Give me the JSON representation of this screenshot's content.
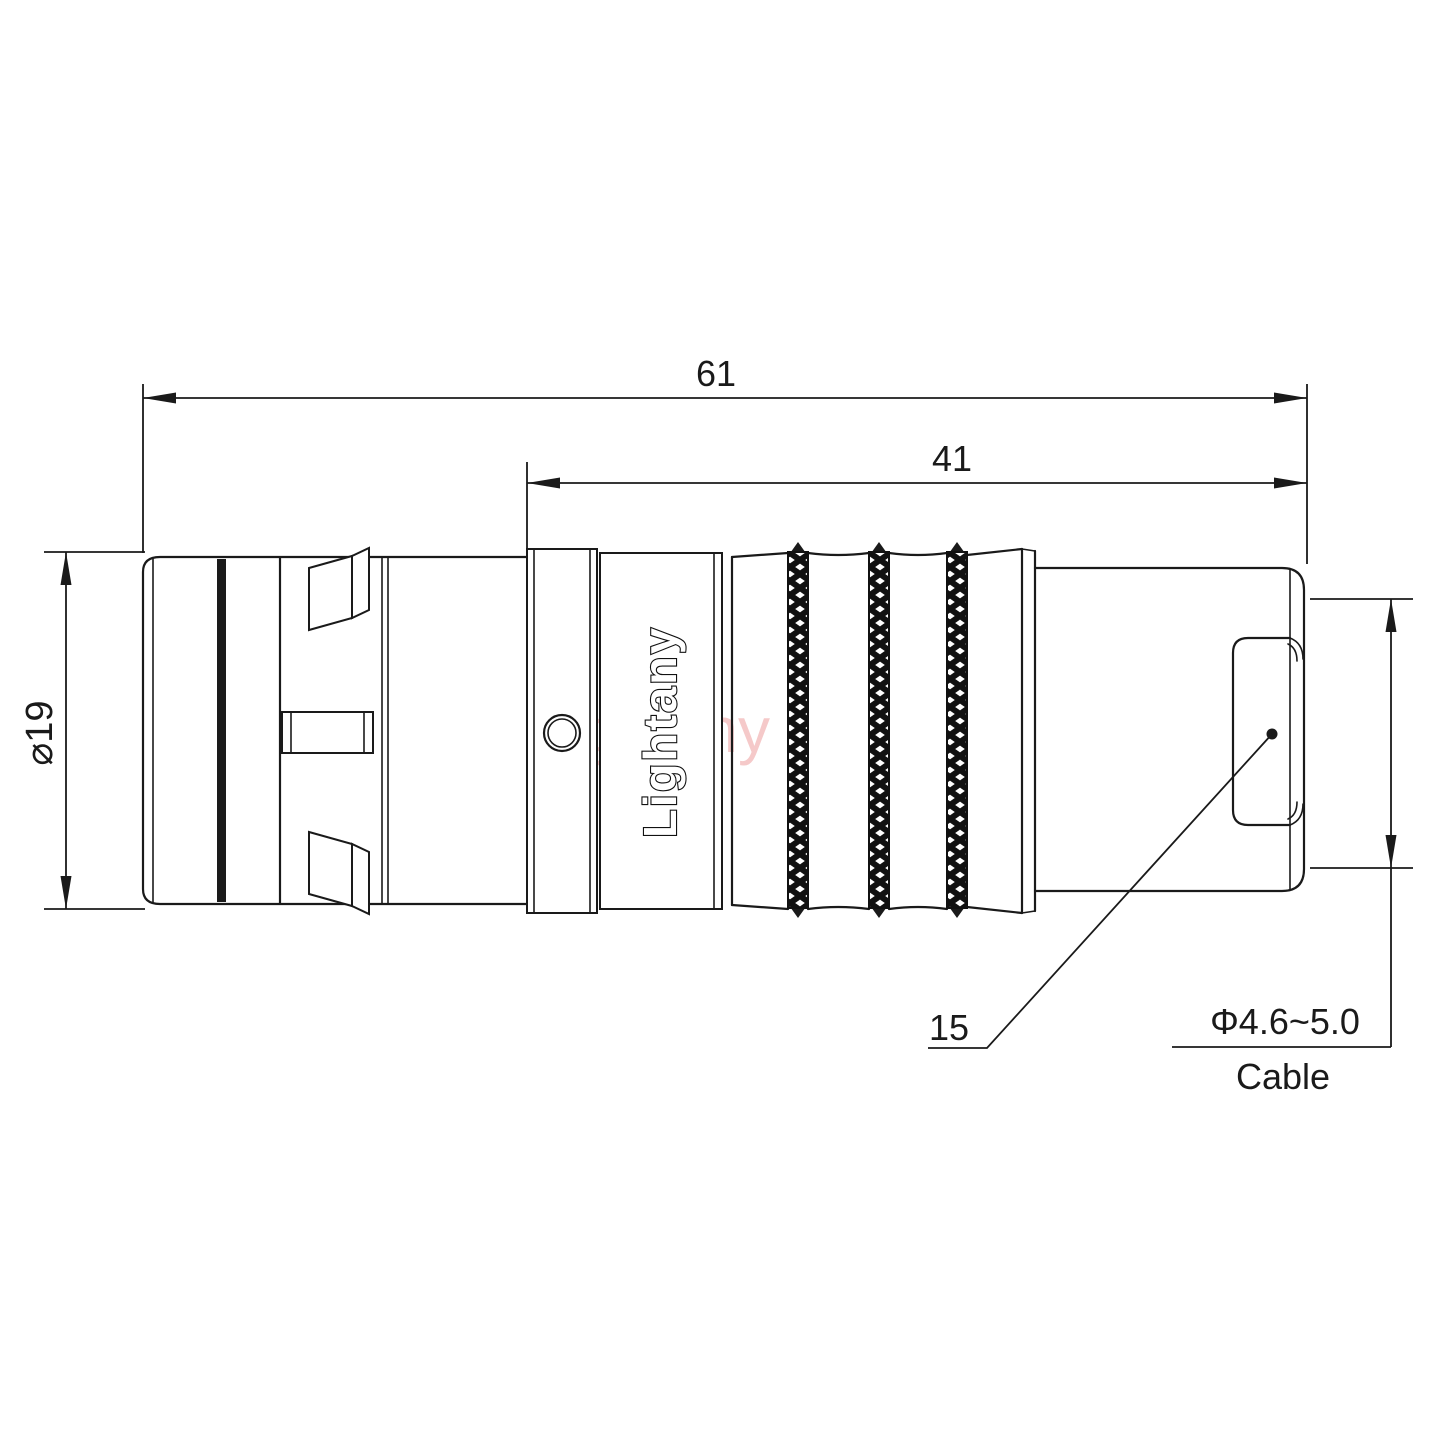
{
  "drawing": {
    "type": "connector-technical-drawing",
    "background": "#ffffff",
    "line_color": "#1a1a1a",
    "watermark_color": "#ec9c9c",
    "dimensions": {
      "overall_length": "61",
      "mid_length": "41",
      "diameter": "⌀19",
      "rear_ref": "15",
      "cable_diameter": "Φ4.6~5.0",
      "cable_label": "Cable"
    },
    "branding": {
      "logo": "Lightany",
      "watermark": "Lightany"
    }
  }
}
